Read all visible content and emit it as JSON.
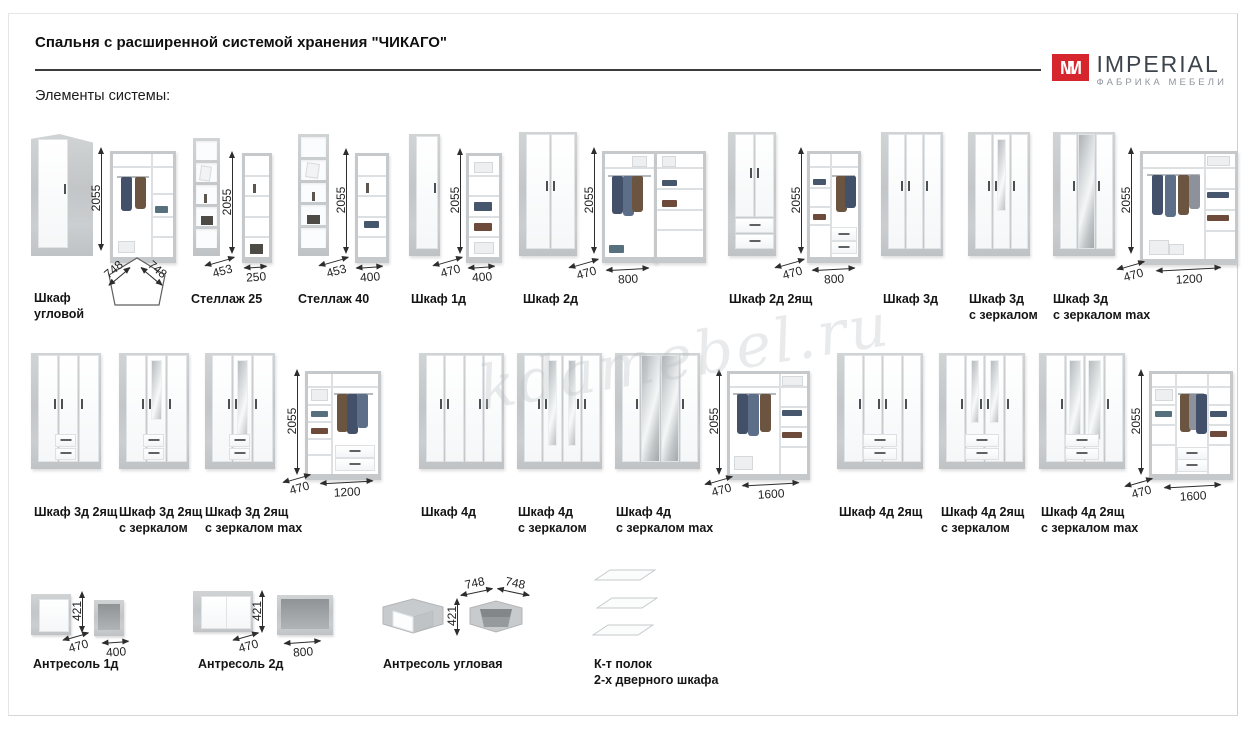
{
  "page": {
    "title": "Спальня с расширенной системой хранения \"ЧИКАГО\"",
    "subtitle": "Элементы системы:",
    "watermark": "kdamebel.ru"
  },
  "logo": {
    "mark": "M",
    "mark2": "M",
    "name": "IMPERIAL",
    "tagline": "ФАБРИКА МЕБЕЛИ",
    "accent": "#d6252c"
  },
  "groups": [
    {
      "label": "Шкаф",
      "label2": "угловой",
      "height": "2055",
      "side_a": "748",
      "side_b": "748"
    },
    {
      "label": "Стеллаж 25",
      "height": "2055",
      "depth": "453",
      "width": "250"
    },
    {
      "label": "Стеллаж 40",
      "height": "2055",
      "depth": "453",
      "width": "400"
    },
    {
      "label": "Шкаф 1д",
      "height": "2055",
      "depth": "470",
      "width": "400"
    },
    {
      "label": "Шкаф 2д",
      "height": "2055",
      "depth": "470",
      "width": "800"
    },
    {
      "label": "Шкаф 2д 2ящ",
      "height": "2055",
      "depth": "470",
      "width": "800"
    },
    {
      "label": "Шкаф 3д"
    },
    {
      "label": "Шкаф 3д",
      "label2": "с зеркалом"
    },
    {
      "label": "Шкаф 3д",
      "label2": "с зеркалом max"
    },
    {
      "height": "2055",
      "depth": "470",
      "width": "1200"
    },
    {
      "label": "Шкаф 3д 2ящ"
    },
    {
      "label": "Шкаф 3д 2ящ",
      "label2": "с зеркалом"
    },
    {
      "label": "Шкаф 3д 2ящ",
      "label2": "с зеркалом max"
    },
    {
      "height": "2055",
      "depth": "470",
      "width": "1200"
    },
    {
      "label": "Шкаф 4д"
    },
    {
      "label": "Шкаф 4д",
      "label2": "с зеркалом"
    },
    {
      "label": "Шкаф 4д",
      "label2": "с зеркалом max"
    },
    {
      "height": "2055",
      "depth": "470",
      "width": "1600"
    },
    {
      "label": "Шкаф 4д 2ящ"
    },
    {
      "label": "Шкаф 4д 2ящ",
      "label2": "с зеркалом"
    },
    {
      "label": "Шкаф 4д 2ящ",
      "label2": "с зеркалом max"
    },
    {
      "height": "2055",
      "depth": "470",
      "width": "1600"
    },
    {
      "label": "Антресоль 1д",
      "height": "421",
      "depth": "470",
      "width": "400"
    },
    {
      "label": "Антресоль 2д",
      "height": "421",
      "depth": "470",
      "width": "800"
    },
    {
      "label": "Антресоль угловая",
      "height": "421",
      "side_a": "748",
      "side_b": "748"
    },
    {
      "label": "К-т полок",
      "label2": "2-х дверного шкафа"
    }
  ]
}
